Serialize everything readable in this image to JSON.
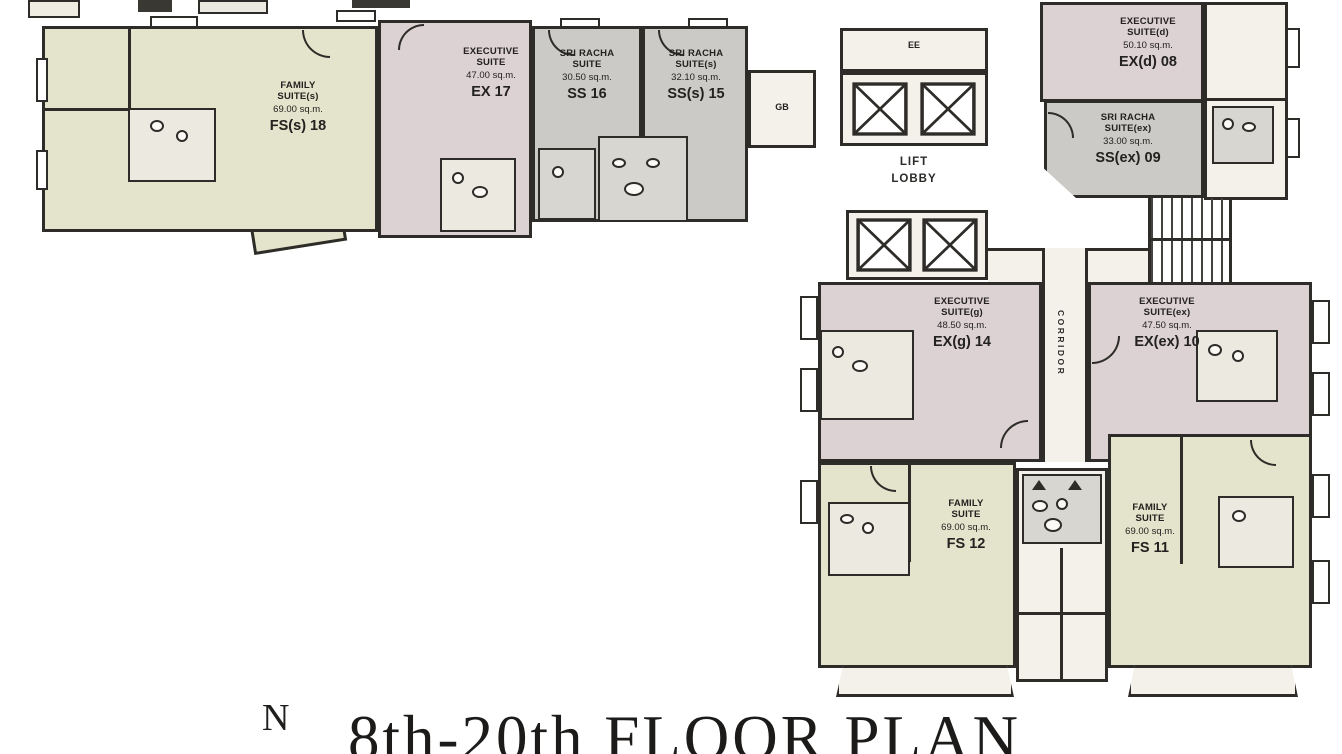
{
  "title": "8th-20th FLOOR PLAN",
  "labels": {
    "north": "N",
    "ee": "EE",
    "gb": "GB",
    "lift_lobby_line1": "LIFT",
    "lift_lobby_line2": "LOBBY",
    "corridor": "CORRIDOR"
  },
  "colors": {
    "family": "#e3e4cb",
    "executive": "#dcd1d3",
    "sriracha": "#cbcac6",
    "light": "#f4f1ea",
    "wall": "#2e2c28"
  },
  "units": {
    "fs18": {
      "name1": "FAMILY",
      "name2": "SUITE(s)",
      "area": "69.00 sq.m.",
      "code": "FS(s) 18"
    },
    "ex17": {
      "name1": "EXECUTIVE",
      "name2": "SUITE",
      "area": "47.00 sq.m.",
      "code": "EX 17"
    },
    "ss16": {
      "name1": "SRI RACHA",
      "name2": "SUITE",
      "area": "30.50 sq.m.",
      "code": "SS 16"
    },
    "ss15": {
      "name1": "SRI RACHA",
      "name2": "SUITE(s)",
      "area": "32.10 sq.m.",
      "code": "SS(s) 15"
    },
    "exd08": {
      "name1": "EXECUTIVE",
      "name2": "SUITE(d)",
      "area": "50.10 sq.m.",
      "code": "EX(d) 08"
    },
    "ssex09": {
      "name1": "SRI RACHA",
      "name2": "SUITE(ex)",
      "area": "33.00 sq.m.",
      "code": "SS(ex) 09"
    },
    "exg14": {
      "name1": "EXECUTIVE",
      "name2": "SUITE(g)",
      "area": "48.50 sq.m.",
      "code": "EX(g) 14"
    },
    "exex10": {
      "name1": "EXECUTIVE",
      "name2": "SUITE(ex)",
      "area": "47.50 sq.m.",
      "code": "EX(ex) 10"
    },
    "fs12": {
      "name1": "FAMILY",
      "name2": "SUITE",
      "area": "69.00 sq.m.",
      "code": "FS 12"
    },
    "fs11": {
      "name1": "FAMILY",
      "name2": "SUITE",
      "area": "69.00 sq.m.",
      "code": "FS 11"
    }
  }
}
